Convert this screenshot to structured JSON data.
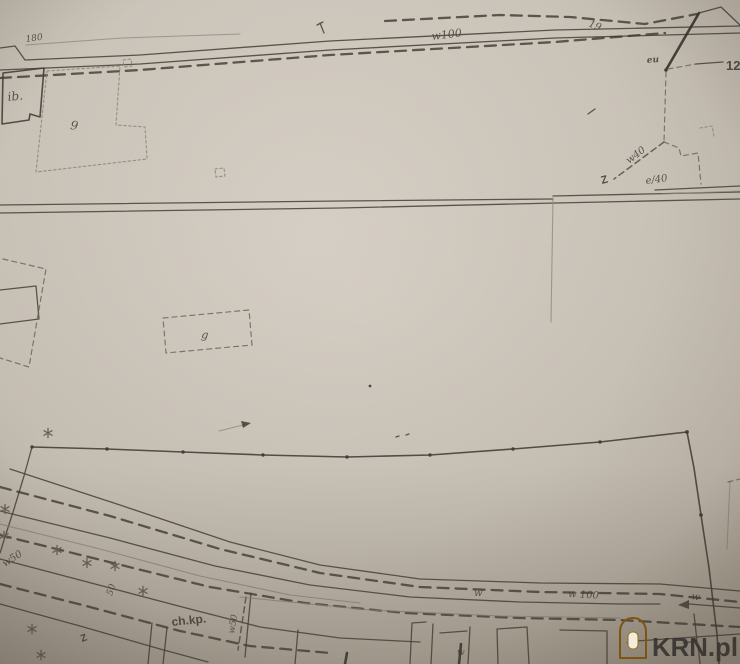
{
  "document": {
    "kind": "scanned cadastral survey map photo",
    "watermark": {
      "brand": "KRN.pl"
    }
  },
  "colors": {
    "paper": "#cfc8be",
    "ink": "#453f38",
    "ink_faint": "#948c80",
    "watermark_text": "#383430",
    "watermark_house": "#e3a127"
  },
  "labels": {
    "dim_180": "180",
    "w100_top": "w100",
    "n19": "19",
    "bld_ib": "ib.",
    "bld_9": "9",
    "eu": "eu",
    "n12": "12",
    "w40": "w40",
    "e40": "e/40",
    "valve_z": "Z",
    "g": "g",
    "w50_left": "w50",
    "n50": "50",
    "chkp": "ch.kp.",
    "w50_vert": "w50",
    "w_mid": "w",
    "w100_bottom": "w 100",
    "w_right": "w",
    "w_bottom": "w"
  }
}
